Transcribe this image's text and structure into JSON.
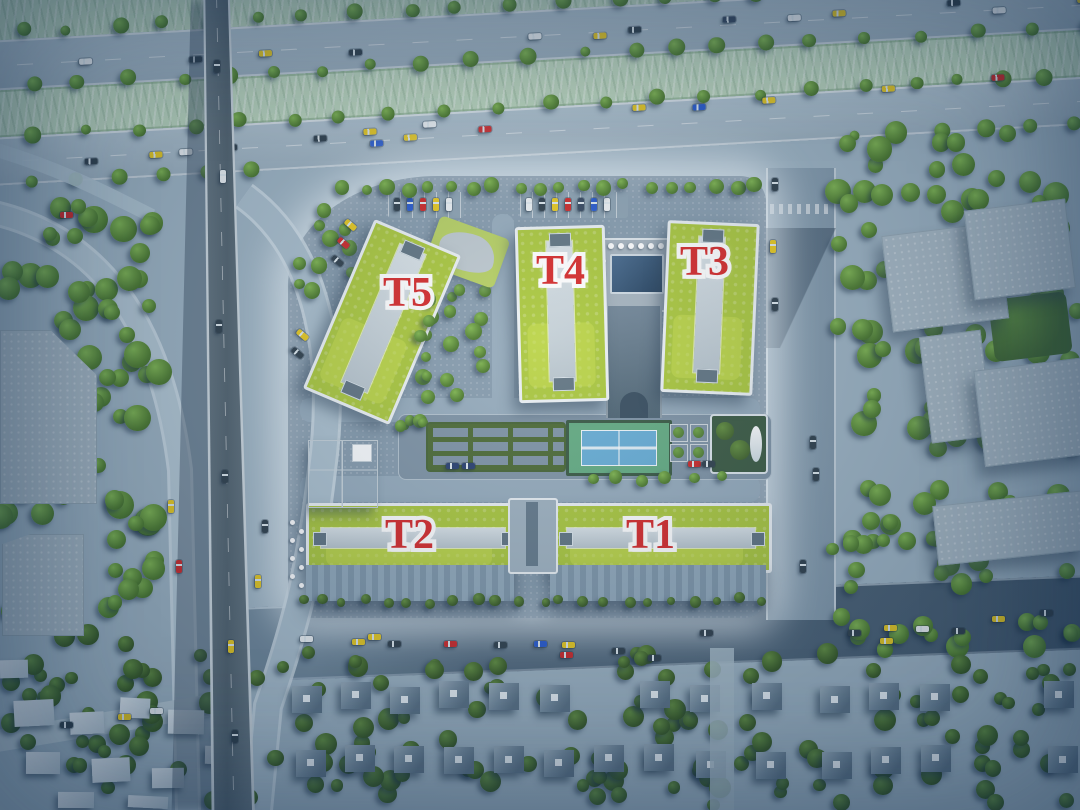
{
  "scene": {
    "description": "aerial-3d-masterplan-render",
    "colors": {
      "accent_red": "#d52323",
      "label_outline": "#ffffff",
      "roof_green": "#a8c637",
      "pool_navy": "#1e3a57",
      "court_blue": "#63abd4",
      "road_gray": "#9db3c2",
      "tree_green": "#4a7a28",
      "median_green": "#bdd8bd"
    }
  },
  "buildings": [
    {
      "id": "t1",
      "label": "T1"
    },
    {
      "id": "t2",
      "label": "T2"
    },
    {
      "id": "t3",
      "label": "T3"
    },
    {
      "id": "t4",
      "label": "T4"
    },
    {
      "id": "t5",
      "label": "T5"
    }
  ]
}
